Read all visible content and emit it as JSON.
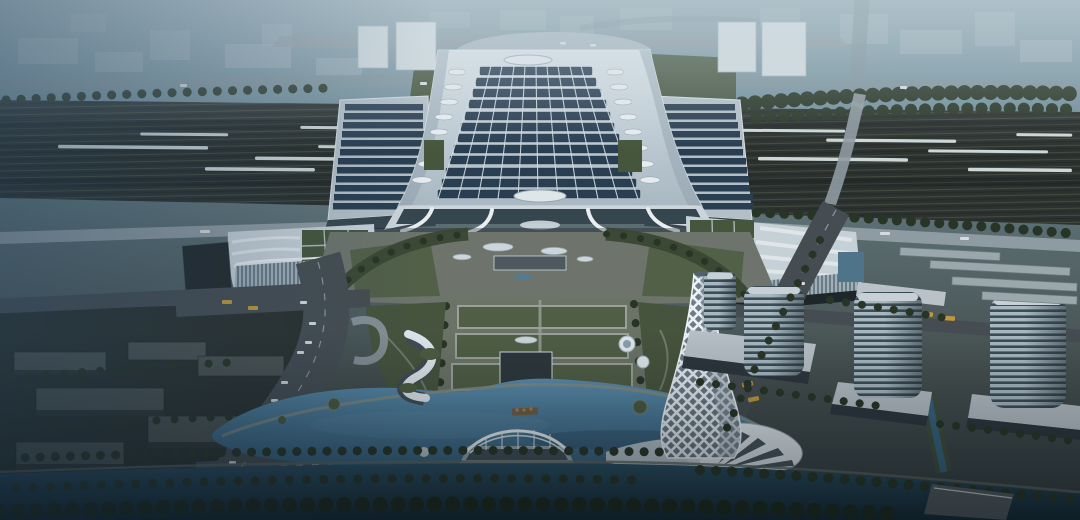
{
  "scene": {
    "kind": "architectural-rendering",
    "subject": "Aerial dusk view of a large high-speed railway station complex with solar-panel roof, landmark lattice tower, lakefront plaza, glass towers and canal",
    "time_of_day": "dusk",
    "view": "aerial-oblique",
    "colors": {
      "sky_top": "#8da5af",
      "sky_upper": "#73909c",
      "sky_mid": "#596b6f",
      "ground_low": "#454f4e",
      "ground_bottom": "#333c40",
      "haze": "#cfdde4",
      "cool_cast": "#24415c",
      "distant_building": "#a7b8bf",
      "distant_road": "#7e929b",
      "rail_bed": "#2c322f",
      "rail_line": "#4e5347",
      "train": "#cdd7d8",
      "viaduct": "#8f9ba2",
      "canopy_frame": "#b3bfc7",
      "solar_panel": "#2a3e52",
      "roof_light": "#d7e0e6",
      "roof_dark": "#a9b8c2",
      "skylight": "#e6ebee",
      "glass_dark": "#36464f",
      "terrace_green": "#46563c",
      "tree": "#283526",
      "lawn": "#4f5e45",
      "hedge": "#3a4734",
      "plaza": "#6e746c",
      "path_light": "#9aa097",
      "road": "#464d52",
      "lane": "#b9bfc0",
      "lake_light": "#5b8dac",
      "lake_deep": "#335e7b",
      "canal_light": "#2a4f63",
      "canal_deep": "#132935",
      "wing_roof": "#c6d0d7",
      "wing_stripe": "#e2e8ec",
      "wing_glass": "#9fb0ba",
      "tower_floor_light": "#a7b8c1",
      "tower_floor_dark": "#3c4d57",
      "sail_light": "#eef3f6",
      "sail_dark": "#b3c1c9",
      "lattice_glass": "#4f6170",
      "podium": "#b6c0c6",
      "block_top": "#4d5452",
      "block_side": "#303634",
      "bus_yellow": "#c2983a",
      "car_white": "#d6dcde",
      "seat_orange": "#c07a3a",
      "shell_white": "#dfe7ec"
    }
  }
}
